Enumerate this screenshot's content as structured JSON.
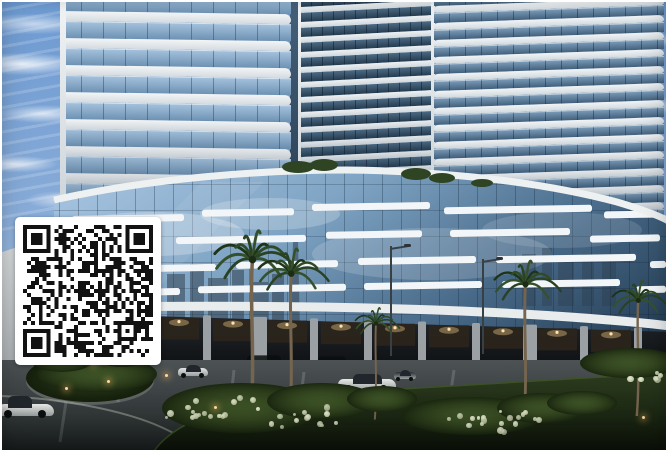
{
  "scene": {
    "subject": "Architectural rendering of curved high-rise residential towers on a glass podium at dusk, palm trees, lawn and driveway in front, QR code overlay at lower left"
  },
  "palette": {
    "frame": "#ffffff",
    "sky_top": "#6d9ad1",
    "sky_bottom": "#c3d7ec",
    "cloud": "#ffffff",
    "slab_white": "#eef1f3",
    "tower_glass": "#7fa3c4",
    "tower_glass_dark": "#33495c",
    "podium_glass_light": "#aac7e3",
    "podium_glass_dark": "#1d3347",
    "streak_white": "#f3f6f8",
    "fascia": "#e9edef",
    "colonnade_dark": "#17191c",
    "column_gray": "#9aa0a4",
    "warm_light": "#d9b87c",
    "road": "#454c4e",
    "lawn": "#253317",
    "bush_green": "#2c3d1f",
    "flower_white": "#d7dec0",
    "palm_frond": "#2a4123",
    "palm_trunk": "#75654e",
    "qr_dark": "#121212",
    "qr_bg": "#ffffff"
  },
  "qr": {
    "left": 13,
    "top": 215,
    "width": 146,
    "height": 148,
    "modules": 33,
    "quiet": 8,
    "seed": 20240613
  },
  "towers": {
    "left": {
      "left": 58,
      "top": -8,
      "width": 231,
      "height": 222,
      "floors": 9,
      "floor_h": 27,
      "slab_h": 10,
      "skew": 0.8
    },
    "middle": {
      "left": 299,
      "top": -4,
      "width": 130,
      "height": 202,
      "floors": 14,
      "floor_h": 15,
      "slab_h": 6,
      "skew": -3
    },
    "right": {
      "left": 432,
      "top": -6,
      "width": 230,
      "height": 248,
      "floors": 15,
      "floor_h": 17,
      "slab_h": 7,
      "skew": -2
    }
  },
  "podium": {
    "streaks": [
      [
        70,
        213,
        112
      ],
      [
        200,
        207,
        92
      ],
      [
        310,
        201,
        118
      ],
      [
        442,
        204,
        148
      ],
      [
        602,
        209,
        54
      ],
      [
        62,
        239,
        94
      ],
      [
        174,
        234,
        130
      ],
      [
        324,
        229,
        96
      ],
      [
        448,
        227,
        120
      ],
      [
        588,
        233,
        70
      ],
      [
        76,
        263,
        138
      ],
      [
        234,
        259,
        102
      ],
      [
        356,
        255,
        118
      ],
      [
        494,
        253,
        140
      ],
      [
        648,
        259,
        16
      ],
      [
        60,
        287,
        118
      ],
      [
        196,
        283,
        148
      ],
      [
        362,
        280,
        118
      ],
      [
        500,
        278,
        118
      ],
      [
        634,
        284,
        30
      ]
    ],
    "columns": [
      {
        "x": 96,
        "w": 8
      },
      {
        "x": 150,
        "w": 8
      },
      {
        "x": 205,
        "w": 8
      },
      {
        "x": 258,
        "w": 14
      },
      {
        "x": 312,
        "w": 8
      },
      {
        "x": 366,
        "w": 8
      },
      {
        "x": 420,
        "w": 8
      },
      {
        "x": 474,
        "w": 8
      },
      {
        "x": 528,
        "w": 14
      },
      {
        "x": 582,
        "w": 8
      },
      {
        "x": 636,
        "w": 8
      }
    ],
    "glows": [
      123,
      177,
      231,
      285,
      339,
      393,
      447,
      501,
      555,
      609
    ],
    "parked": [
      {
        "x": 262,
        "w": 34
      },
      {
        "x": 330,
        "w": 28
      },
      {
        "x": 556,
        "w": 34
      },
      {
        "x": 602,
        "w": 26
      }
    ]
  },
  "palms": [
    {
      "x": 250,
      "base": 426,
      "h": 168,
      "s": 1.1
    },
    {
      "x": 289,
      "base": 422,
      "h": 150,
      "s": 0.95
    },
    {
      "x": 374,
      "base": 418,
      "h": 96,
      "s": 0.6
    },
    {
      "x": 523,
      "base": 422,
      "h": 140,
      "s": 0.9
    },
    {
      "x": 636,
      "base": 414,
      "h": 116,
      "s": 0.75
    }
  ],
  "lamps": [
    {
      "x": 388,
      "base": 354,
      "h": 110
    },
    {
      "x": 480,
      "base": 352,
      "h": 95
    }
  ],
  "cars": [
    {
      "x": -4,
      "y": 394,
      "w": 56,
      "h": 22,
      "body": "#e9eae7",
      "type": "sport"
    },
    {
      "x": 176,
      "y": 363,
      "w": 30,
      "h": 13,
      "body": "#e0e3e3",
      "type": "sedan"
    },
    {
      "x": 336,
      "y": 372,
      "w": 58,
      "h": 18,
      "body": "#e7e9e7",
      "type": "sedan"
    },
    {
      "x": 392,
      "y": 368,
      "w": 22,
      "h": 11,
      "body": "#2a2f33",
      "type": "sedan"
    },
    {
      "x": 612,
      "y": 356,
      "w": 24,
      "h": 11,
      "body": "#c9cdcd",
      "type": "sedan"
    },
    {
      "x": 638,
      "y": 358,
      "w": 28,
      "h": 12,
      "body": "#31373b",
      "type": "sedan"
    }
  ],
  "bushes": [
    {
      "x": 95,
      "y": 372,
      "w": 120,
      "h": 36
    },
    {
      "x": 60,
      "y": 354,
      "w": 70,
      "h": 32
    },
    {
      "x": 120,
      "y": 350,
      "w": 64,
      "h": 30
    },
    {
      "x": 240,
      "y": 406,
      "w": 160,
      "h": 50
    },
    {
      "x": 320,
      "y": 399,
      "w": 110,
      "h": 36
    },
    {
      "x": 470,
      "y": 414,
      "w": 140,
      "h": 38
    },
    {
      "x": 540,
      "y": 406,
      "w": 90,
      "h": 30
    },
    {
      "x": 628,
      "y": 361,
      "w": 100,
      "h": 30
    },
    {
      "x": 380,
      "y": 397,
      "w": 70,
      "h": 26
    },
    {
      "x": 580,
      "y": 401,
      "w": 70,
      "h": 24
    }
  ],
  "flower_clusters": [
    {
      "x": 210,
      "y": 404,
      "r": 55
    },
    {
      "x": 298,
      "y": 412,
      "r": 40
    },
    {
      "x": 468,
      "y": 420,
      "r": 36
    },
    {
      "x": 518,
      "y": 414,
      "r": 26
    },
    {
      "x": 640,
      "y": 372,
      "r": 20
    }
  ],
  "path_lights": [
    {
      "x": 63,
      "y": 385
    },
    {
      "x": 105,
      "y": 378
    },
    {
      "x": 163,
      "y": 372
    },
    {
      "x": 212,
      "y": 404
    },
    {
      "x": 640,
      "y": 414
    },
    {
      "x": 90,
      "y": 360
    }
  ]
}
